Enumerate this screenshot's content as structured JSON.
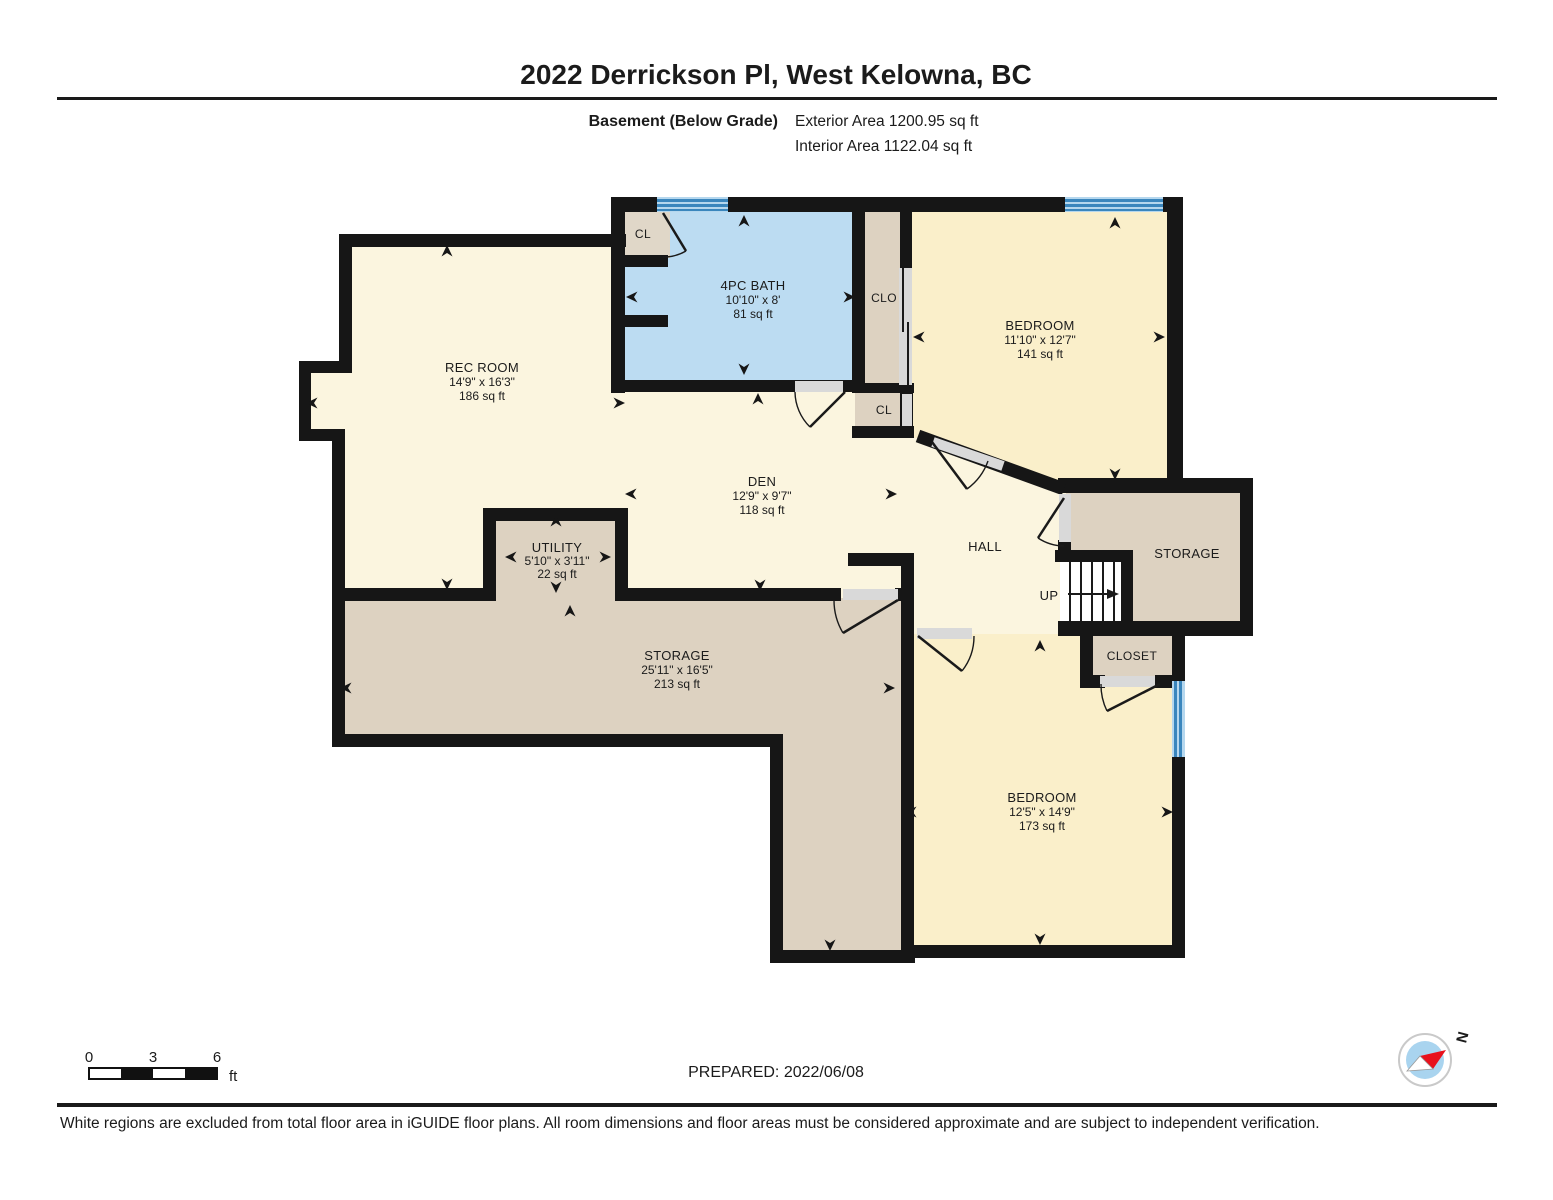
{
  "header": {
    "title": "2022 Derrickson Pl, West Kelowna, BC",
    "floor_label": "Basement (Below Grade)",
    "exterior_area": "Exterior Area 1200.95 sq ft",
    "interior_area": "Interior Area 1122.04 sq ft"
  },
  "plan": {
    "rooms": {
      "rec_room": {
        "name": "REC ROOM",
        "dims": "14'9\" x 16'3\"",
        "area": "186 sq ft"
      },
      "bath": {
        "name": "4PC BATH",
        "dims": "10'10\" x 8'",
        "area": "81 sq ft"
      },
      "bedroom_top": {
        "name": "BEDROOM",
        "dims": "11'10\" x 12'7\"",
        "area": "141 sq ft"
      },
      "den": {
        "name": "DEN",
        "dims": "12'9\" x 9'7\"",
        "area": "118 sq ft"
      },
      "utility": {
        "name": "UTILITY",
        "dims": "5'10\" x 3'11\"",
        "area": "22 sq ft"
      },
      "storage_main": {
        "name": "STORAGE",
        "dims": "25'11\" x 16'5\"",
        "area": "213 sq ft"
      },
      "bedroom_bottom": {
        "name": "BEDROOM",
        "dims": "12'5\" x 14'9\"",
        "area": "173 sq ft"
      },
      "hall": {
        "name": "HALL"
      },
      "storage_right": {
        "name": "STORAGE"
      },
      "closet": {
        "name": "CLOSET"
      },
      "closet_bath": {
        "name": "CL"
      },
      "closet_clo": {
        "name": "CLO"
      },
      "closet_hall": {
        "name": "CL"
      },
      "stairs": {
        "name": "UP"
      }
    },
    "colors": {
      "room_cream": "#fbf5df",
      "room_yellow": "#faefca",
      "room_tan": "#ddd2c1",
      "bath_blue": "#bcdcf2",
      "wall": "#161616",
      "window_blue": "#3a86bd",
      "door_gap": "#d9d9d9",
      "compass_blue": "#a9d4ef",
      "compass_red": "#e8111c"
    }
  },
  "footer": {
    "scale": {
      "tick0": "0",
      "tick1": "3",
      "tick2": "6",
      "unit": "ft"
    },
    "prepared": "PREPARED: 2022/06/08",
    "compass_label": "N",
    "disclaimer": "White regions are excluded from total floor area in iGUIDE floor plans. All room dimensions and floor areas must be considered approximate and are subject to independent verification."
  }
}
